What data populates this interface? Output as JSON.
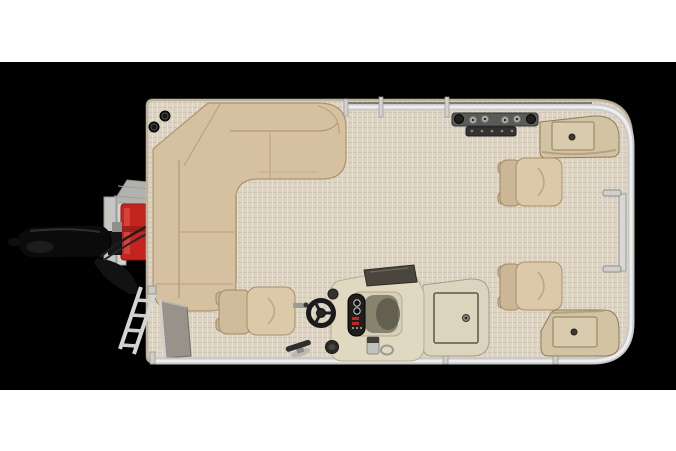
{
  "scene": {
    "description": "Overhead floor-plan product photo of a pontoon fishing boat on a black background, letterboxed by white bands",
    "view": "top-down",
    "subject": "pontoon boat interior layout"
  },
  "palette": {
    "photo-bg": "#000000",
    "page-bg": "#ffffff",
    "deck-floor": "#dcd3c3",
    "deck-trim": "#c3b8a2",
    "upholstery": "#d5c0a0",
    "upholstery-dark": "#cbb795",
    "upholstery-seam": "#a8916f",
    "console": "#e1d8c1",
    "console-dark": "#4a463d",
    "storage": "#d2c3a3",
    "storage-lid": "#d9cbad",
    "rail": "#c9c9c9",
    "rail-bright": "#ededed",
    "speaker": "#161616",
    "fuel-red": "#c32420",
    "motor-black": "#0b0b0b",
    "ladder": "#d6d6d3",
    "gate-panel": "#98938a",
    "instrument-black": "#201e1a"
  },
  "parts": {
    "pontoon_deck": "Pontoon deck with woven vinyl flooring",
    "l_lounge": "L-shaped stern lounge seating",
    "captain_chair": "Captain's helm chair",
    "helm_console": "Helm console with windscreen and gauges",
    "steering_wheel": "Steering wheel",
    "livewell_box": "Deck storage / livewell box with access door",
    "fishing_chair_forward": "Bow fishing chair (top)",
    "fishing_chair_aft": "Bow fishing chair (bottom)",
    "bow_storage_top": "Bow corner storage locker with speakers (top)",
    "bow_storage_bottom": "Bow corner storage locker with speakers (bottom)",
    "rod_holder_rack": "Fishing rod holder rack",
    "outboard_motor": "Outboard motor",
    "fuel_tank": "Red portable fuel tank",
    "transom_platform": "Stern motor-mount platform",
    "boarding_ladder": "Stern boarding ladder",
    "stern_gate": "Stern gate privacy panel",
    "perimeter_rail": "Perimeter fence rail",
    "bow_gate": "Bow boarding gate",
    "corner_speakers": "Corner-mounted speakers",
    "dock_cleat": "Dock cleat",
    "cup_holder": "Cup holder",
    "gate_latch": "Gate latch hardware"
  }
}
